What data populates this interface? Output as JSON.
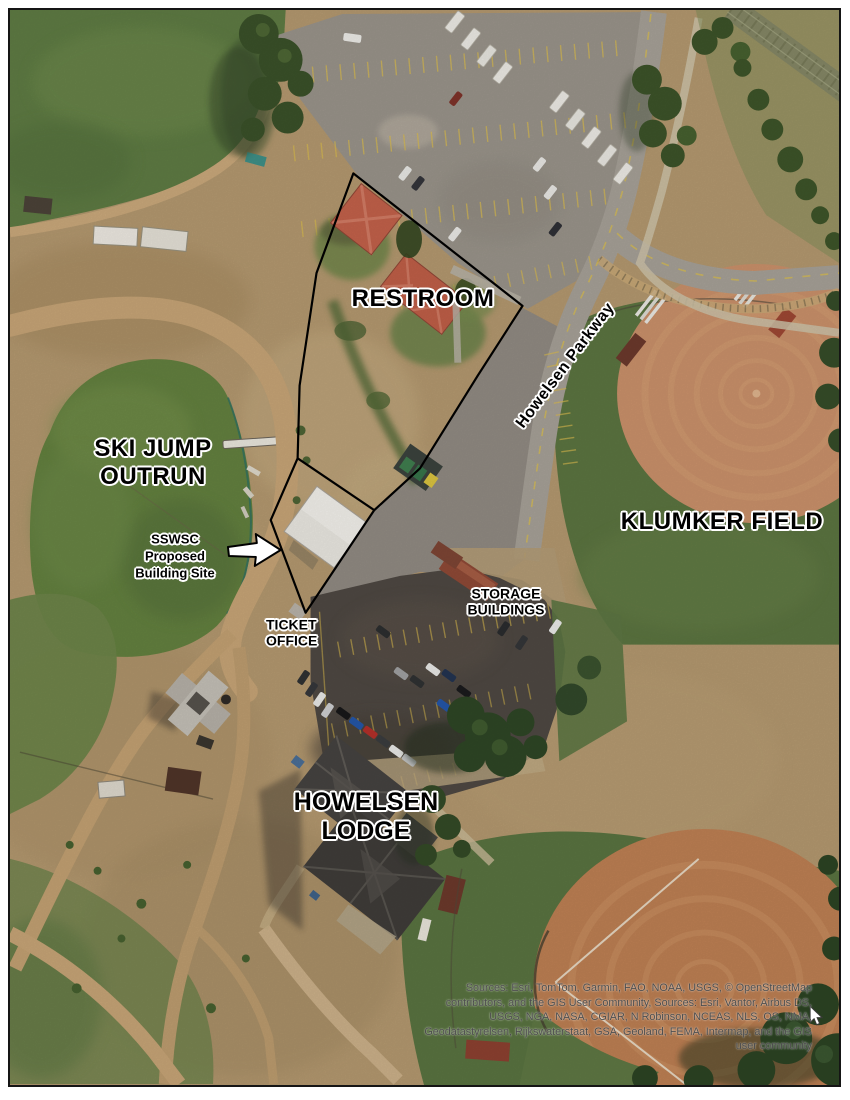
{
  "map": {
    "labels": {
      "restroom": "RESTROOM",
      "ski_jump_line1": "SKI JUMP",
      "ski_jump_line2": "OUTRUN",
      "klumker_field": "KLUMKER FIELD",
      "howelsen_parkway": "Howelsen Parkway",
      "lodge_line1": "HOWELSEN",
      "lodge_line2": "LODGE",
      "sswsc_line1": "SSWSC",
      "sswsc_line2": "Proposed",
      "sswsc_line3": "Building Site",
      "ticket_line1": "TICKET",
      "ticket_line2": "OFFICE",
      "storage_line1": "STORAGE",
      "storage_line2": "BUILDINGS"
    },
    "attribution": {
      "lines": [
        "Sources: Esri, TomTom, Garmin, FAO, NOAA, USGS, © OpenStreetMap",
        "contributors, and the GIS User Community, Sources: Esri, Vantor, Airbus DS,",
        "USGS, NGA, NASA, CGIAR, N Robinson, NCEAS, NLS, OS, NMA,",
        "Geodatastyrelsen, Rijkswaterstaat, GSA, Geoland, FEMA, Intermap, and the GIS",
        "user community"
      ]
    },
    "colors": {
      "parcel_outline": "#000000",
      "label_halo": "#ffffff",
      "arrow_fill": "#ffffff",
      "attribution_text": "#4d4d4d"
    }
  }
}
